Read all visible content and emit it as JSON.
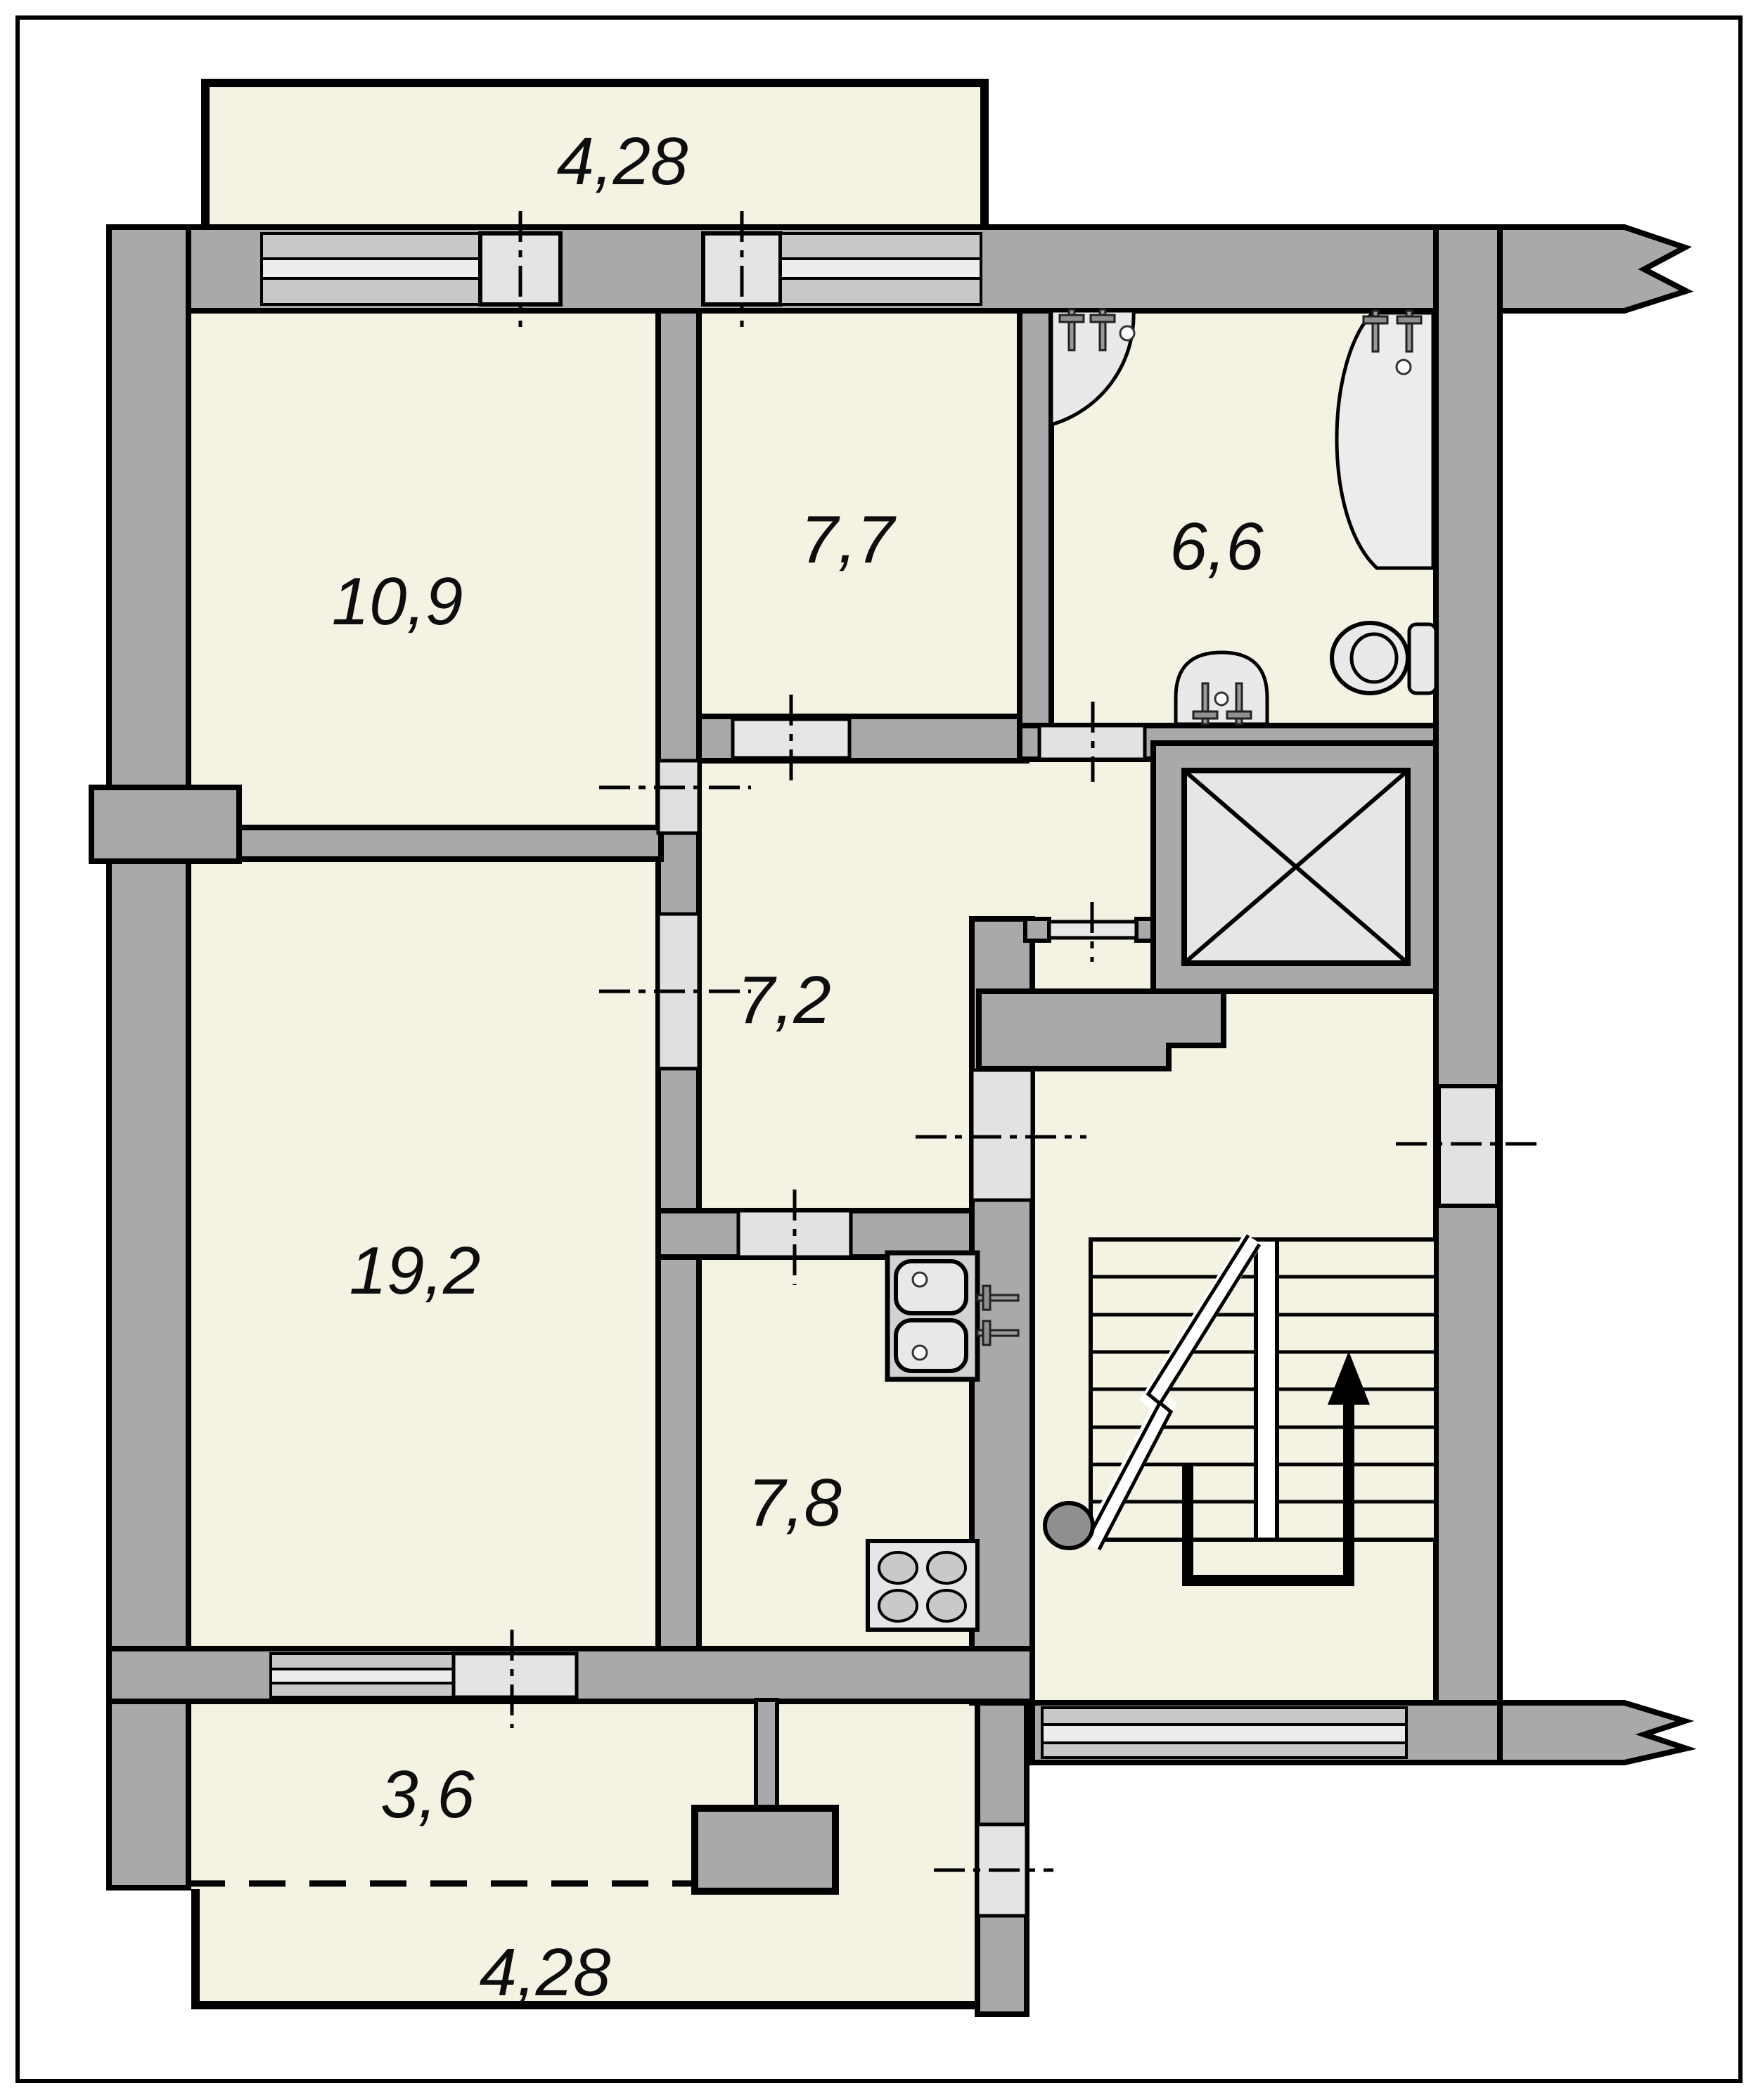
{
  "title": "apartment-floor-plan",
  "colors": {
    "wall_gray": "#a9a9a9",
    "floor_cream": "#f4f2e3",
    "window_light": "#e4e4e4",
    "window_stripe_dark": "#c8c8c8",
    "window_stripe_light": "#ececec",
    "elevator_fill": "#e6e6e6",
    "fixture_fill": "#e9e9e9",
    "newel_gray": "#8f8f8f",
    "line_black": "#000000"
  },
  "rooms": [
    {
      "id": "balcony-top",
      "area": "4,28"
    },
    {
      "id": "room-top-left",
      "area": "10,9"
    },
    {
      "id": "room-top-middle",
      "area": "7,7"
    },
    {
      "id": "bathroom",
      "area": "6,6"
    },
    {
      "id": "hall",
      "area": "7,2"
    },
    {
      "id": "living-room",
      "area": "19,2"
    },
    {
      "id": "kitchen",
      "area": "7,8"
    },
    {
      "id": "balcony-left",
      "area": "3,6"
    },
    {
      "id": "balcony-bottom",
      "area": "4,28"
    }
  ]
}
